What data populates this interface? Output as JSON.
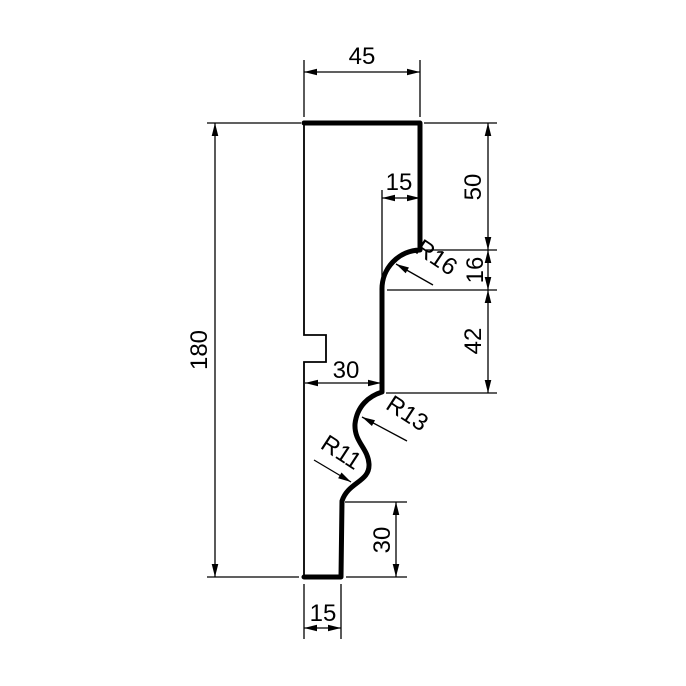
{
  "drawing": {
    "type": "technical-profile-cross-section",
    "colors": {
      "line": "#000000",
      "background": "#ffffff"
    },
    "labels": {
      "top_width": "45",
      "overall_height": "180",
      "upper_right_height": "50",
      "cove_height": "16",
      "middle_right_height": "42",
      "upper_step_width": "15",
      "middle_width": "30",
      "lower_right_height": "30",
      "bottom_width": "15",
      "cove_radius": "R16",
      "ogee_upper_radius": "R13",
      "ogee_lower_radius": "R11"
    }
  }
}
